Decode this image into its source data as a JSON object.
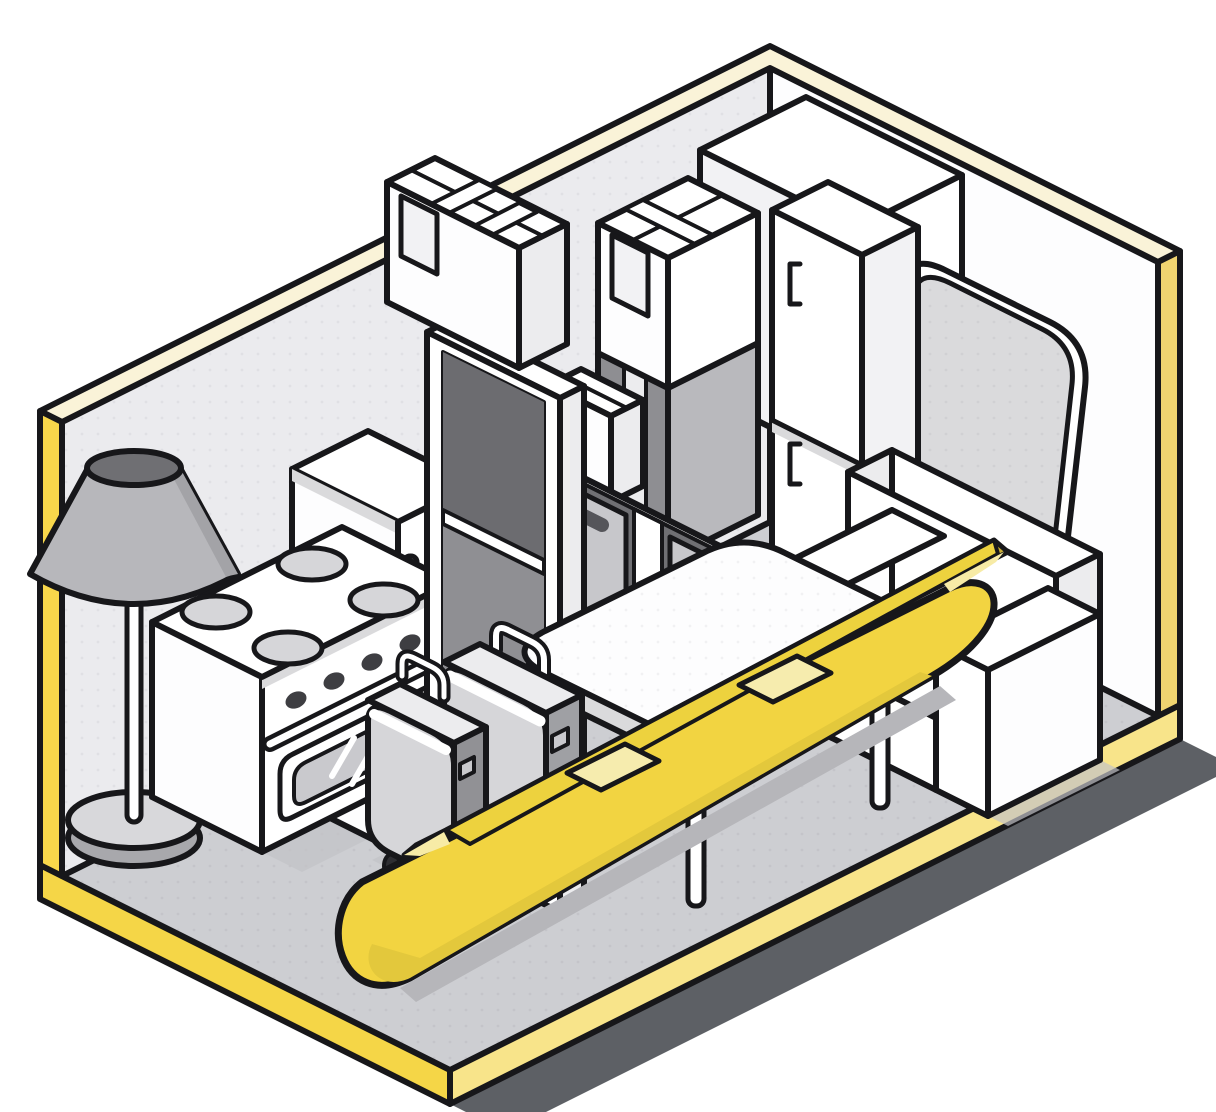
{
  "meta": {
    "title": "Isometric self-storage unit illustration",
    "description": "Open-corner storage unit with yellow-trimmed walls and floor slab, packed with household belongings: floor lamp, stove, refrigerator, open shelving, taped moving boxes, bin cubby, wardrobe, corner cabinet, leaning mattress, sofa, dining table, two wheeled suitcases and a yellow canoe."
  },
  "palette": {
    "outline": "#17171a",
    "wallLeft": "#ebebee",
    "wallRight": "#fdfdfe",
    "trimCream": "#faf3d8",
    "edgeYellowLeft": "#f8d74b",
    "edgeYellowRight": "#f0d470",
    "slabYellowBright": "#f5d647",
    "slabYellowPale": "#f8e48a",
    "floorGray": "#cdced2",
    "groundShadow": "#5d6065",
    "castShadow": "#c3c3c7",
    "white": "#ffffff",
    "offWhite": "#f2f2f4",
    "paleGray": "#ececee",
    "lightGray": "#d6d6d9",
    "midGray": "#b9b9bd",
    "slateGray": "#9a9a9e",
    "darkGray": "#8e8e92",
    "deepGray": "#707074",
    "shadeLine": "#dadadc",
    "knobDark": "#3e3e42",
    "wheelDark": "#2e2e32",
    "lampShade": "#b7b7bb",
    "lampShadeDark": "#a3a3a7",
    "lampTop": "#6f6f73",
    "lampBaseTop": "#d8d8db",
    "lampBaseSide": "#a8a8ac",
    "windowGray": "#c9c9cd",
    "binGray": "#c7c7cb",
    "binHandle": "#55555a",
    "canoeYellow": "#f2d441",
    "canoeOlive": "#c9ae35",
    "canoeBright": "#edd23e",
    "canoePale": "#f7eba6",
    "canoeCream": "#f6ecae",
    "canoeShadow": "#b6b6ba",
    "suitcaseSide": "#9fa0a4",
    "suitcaseSideDark": "#919195"
  },
  "scene": {
    "room": {
      "left_wall": "light gray interior, yellow outer edge, cream top trim",
      "right_wall": "white interior, yellow outer edge, cream top trim",
      "floor": "gray slab with bright and pale yellow edges over dark drop shadow"
    },
    "items": [
      {
        "id": "floor-lamp",
        "label": "gray floor lamp"
      },
      {
        "id": "kitchen-stove",
        "label": "white stove with four burners, knobs and oven window"
      },
      {
        "id": "refrigerator",
        "label": "white refrigerator with vertical handle"
      },
      {
        "id": "open-shelf-unit",
        "label": "tall white open shelving unit"
      },
      {
        "id": "shelf-top-box",
        "label": "taped moving box on shelf"
      },
      {
        "id": "sealed-box",
        "label": "white sealed moving box with tape"
      },
      {
        "id": "tall-gray-box",
        "label": "tall gray box with tape strip"
      },
      {
        "id": "small-taped-box",
        "label": "small white taped box"
      },
      {
        "id": "bin-cubby",
        "label": "two-bay cubby with gray handle bins"
      },
      {
        "id": "corner-cabinet",
        "label": "large white corner cabinet"
      },
      {
        "id": "wardrobe",
        "label": "white wardrobe with two doors and bracket handles"
      },
      {
        "id": "mattress",
        "label": "light gray mattress leaning on wall"
      },
      {
        "id": "sofa",
        "label": "white two-seat sofa"
      },
      {
        "id": "dining-table",
        "label": "white rounded dining table"
      },
      {
        "id": "large-suitcase",
        "label": "large gray wheeled suitcase"
      },
      {
        "id": "small-suitcase",
        "label": "small gray wheeled suitcase"
      },
      {
        "id": "canoe",
        "label": "yellow canoe with two cream thwarts"
      }
    ]
  }
}
